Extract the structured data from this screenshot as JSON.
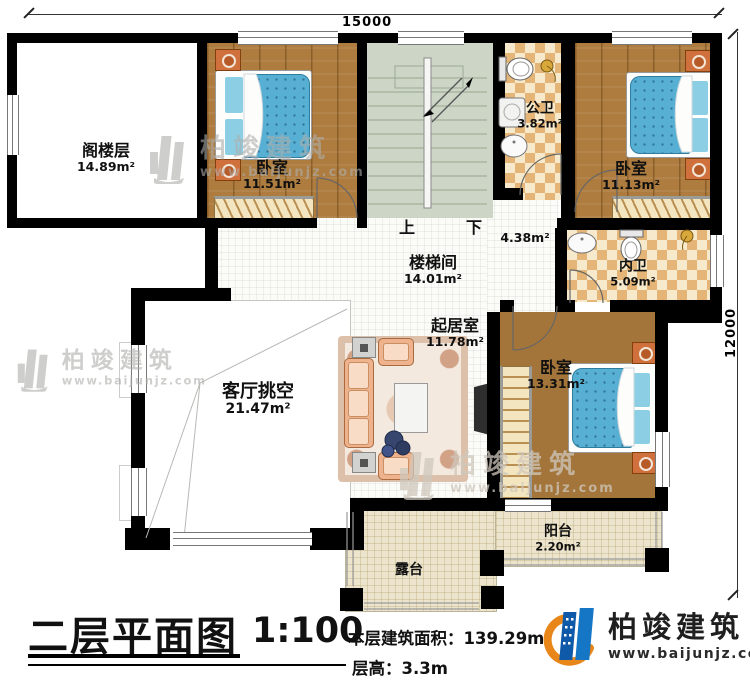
{
  "dimensions": {
    "top": "15000",
    "right": "12000"
  },
  "rooms": {
    "attic": {
      "label": "阁楼层",
      "area": "14.89m²"
    },
    "bedroom_top": {
      "label": "卧室",
      "area": "11.51m²"
    },
    "public_bath": {
      "label": "公卫",
      "area": "3.82m²"
    },
    "bedroom_right": {
      "label": "卧室",
      "area": "11.13m²"
    },
    "stairwell": {
      "label": "楼梯间",
      "area": "14.01m²"
    },
    "hallway": {
      "area": "4.38m²"
    },
    "inner_bath": {
      "label": "内卫",
      "area": "5.09m²"
    },
    "living": {
      "label": "起居室",
      "area": "11.78m²"
    },
    "void": {
      "label": "客厅挑空",
      "area": "21.47m²"
    },
    "bedroom_bottom": {
      "label": "卧室",
      "area": "13.31m²"
    },
    "balcony": {
      "label": "阳台",
      "area": "2.20m²"
    },
    "terrace": {
      "label": "露台"
    }
  },
  "stairs": {
    "up": "上",
    "down": "下"
  },
  "titleblock": {
    "title": "二层平面图",
    "scale": "1:100",
    "area_text": "本层建筑面积：139.29m²",
    "floor_height_text": "层高：3.3m"
  },
  "brand": {
    "name": "柏竣建筑",
    "website": "www.baijunjz.com"
  },
  "watermark": {
    "name": "柏竣建筑",
    "website": "www.baijunjz.com"
  },
  "colors": {
    "wall": "#000000",
    "wood_floor": "#ad7c3e",
    "tile_light": "#f6e9cc",
    "tile_dark": "#e4b577",
    "stair_floor": "#cdd6c6",
    "mattress_blue": "#57b0d4",
    "terrace_floor": "#ece4cc",
    "brand_blue": "#1464ae",
    "brand_orange": "#e8861a"
  }
}
